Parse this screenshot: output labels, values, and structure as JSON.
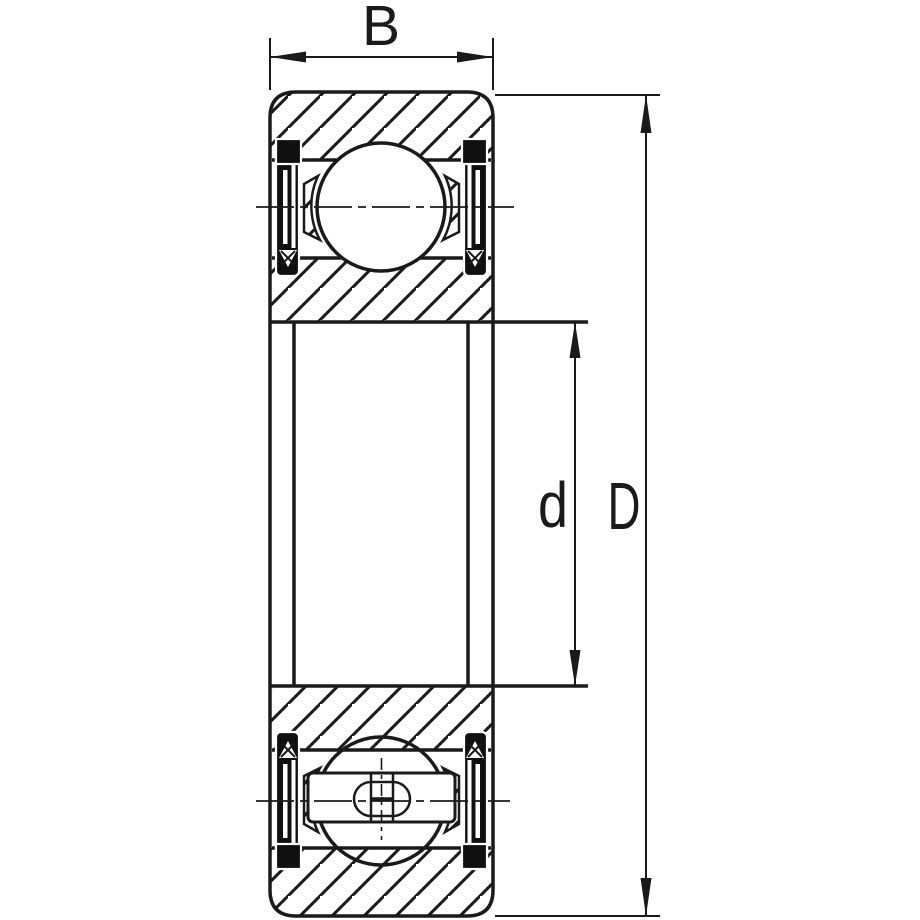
{
  "drawing": {
    "labels": {
      "width": "B",
      "bore_diameter": "d",
      "outer_diameter": "D"
    },
    "colors": {
      "line": "#1a1a1a",
      "background": "#ffffff"
    }
  }
}
